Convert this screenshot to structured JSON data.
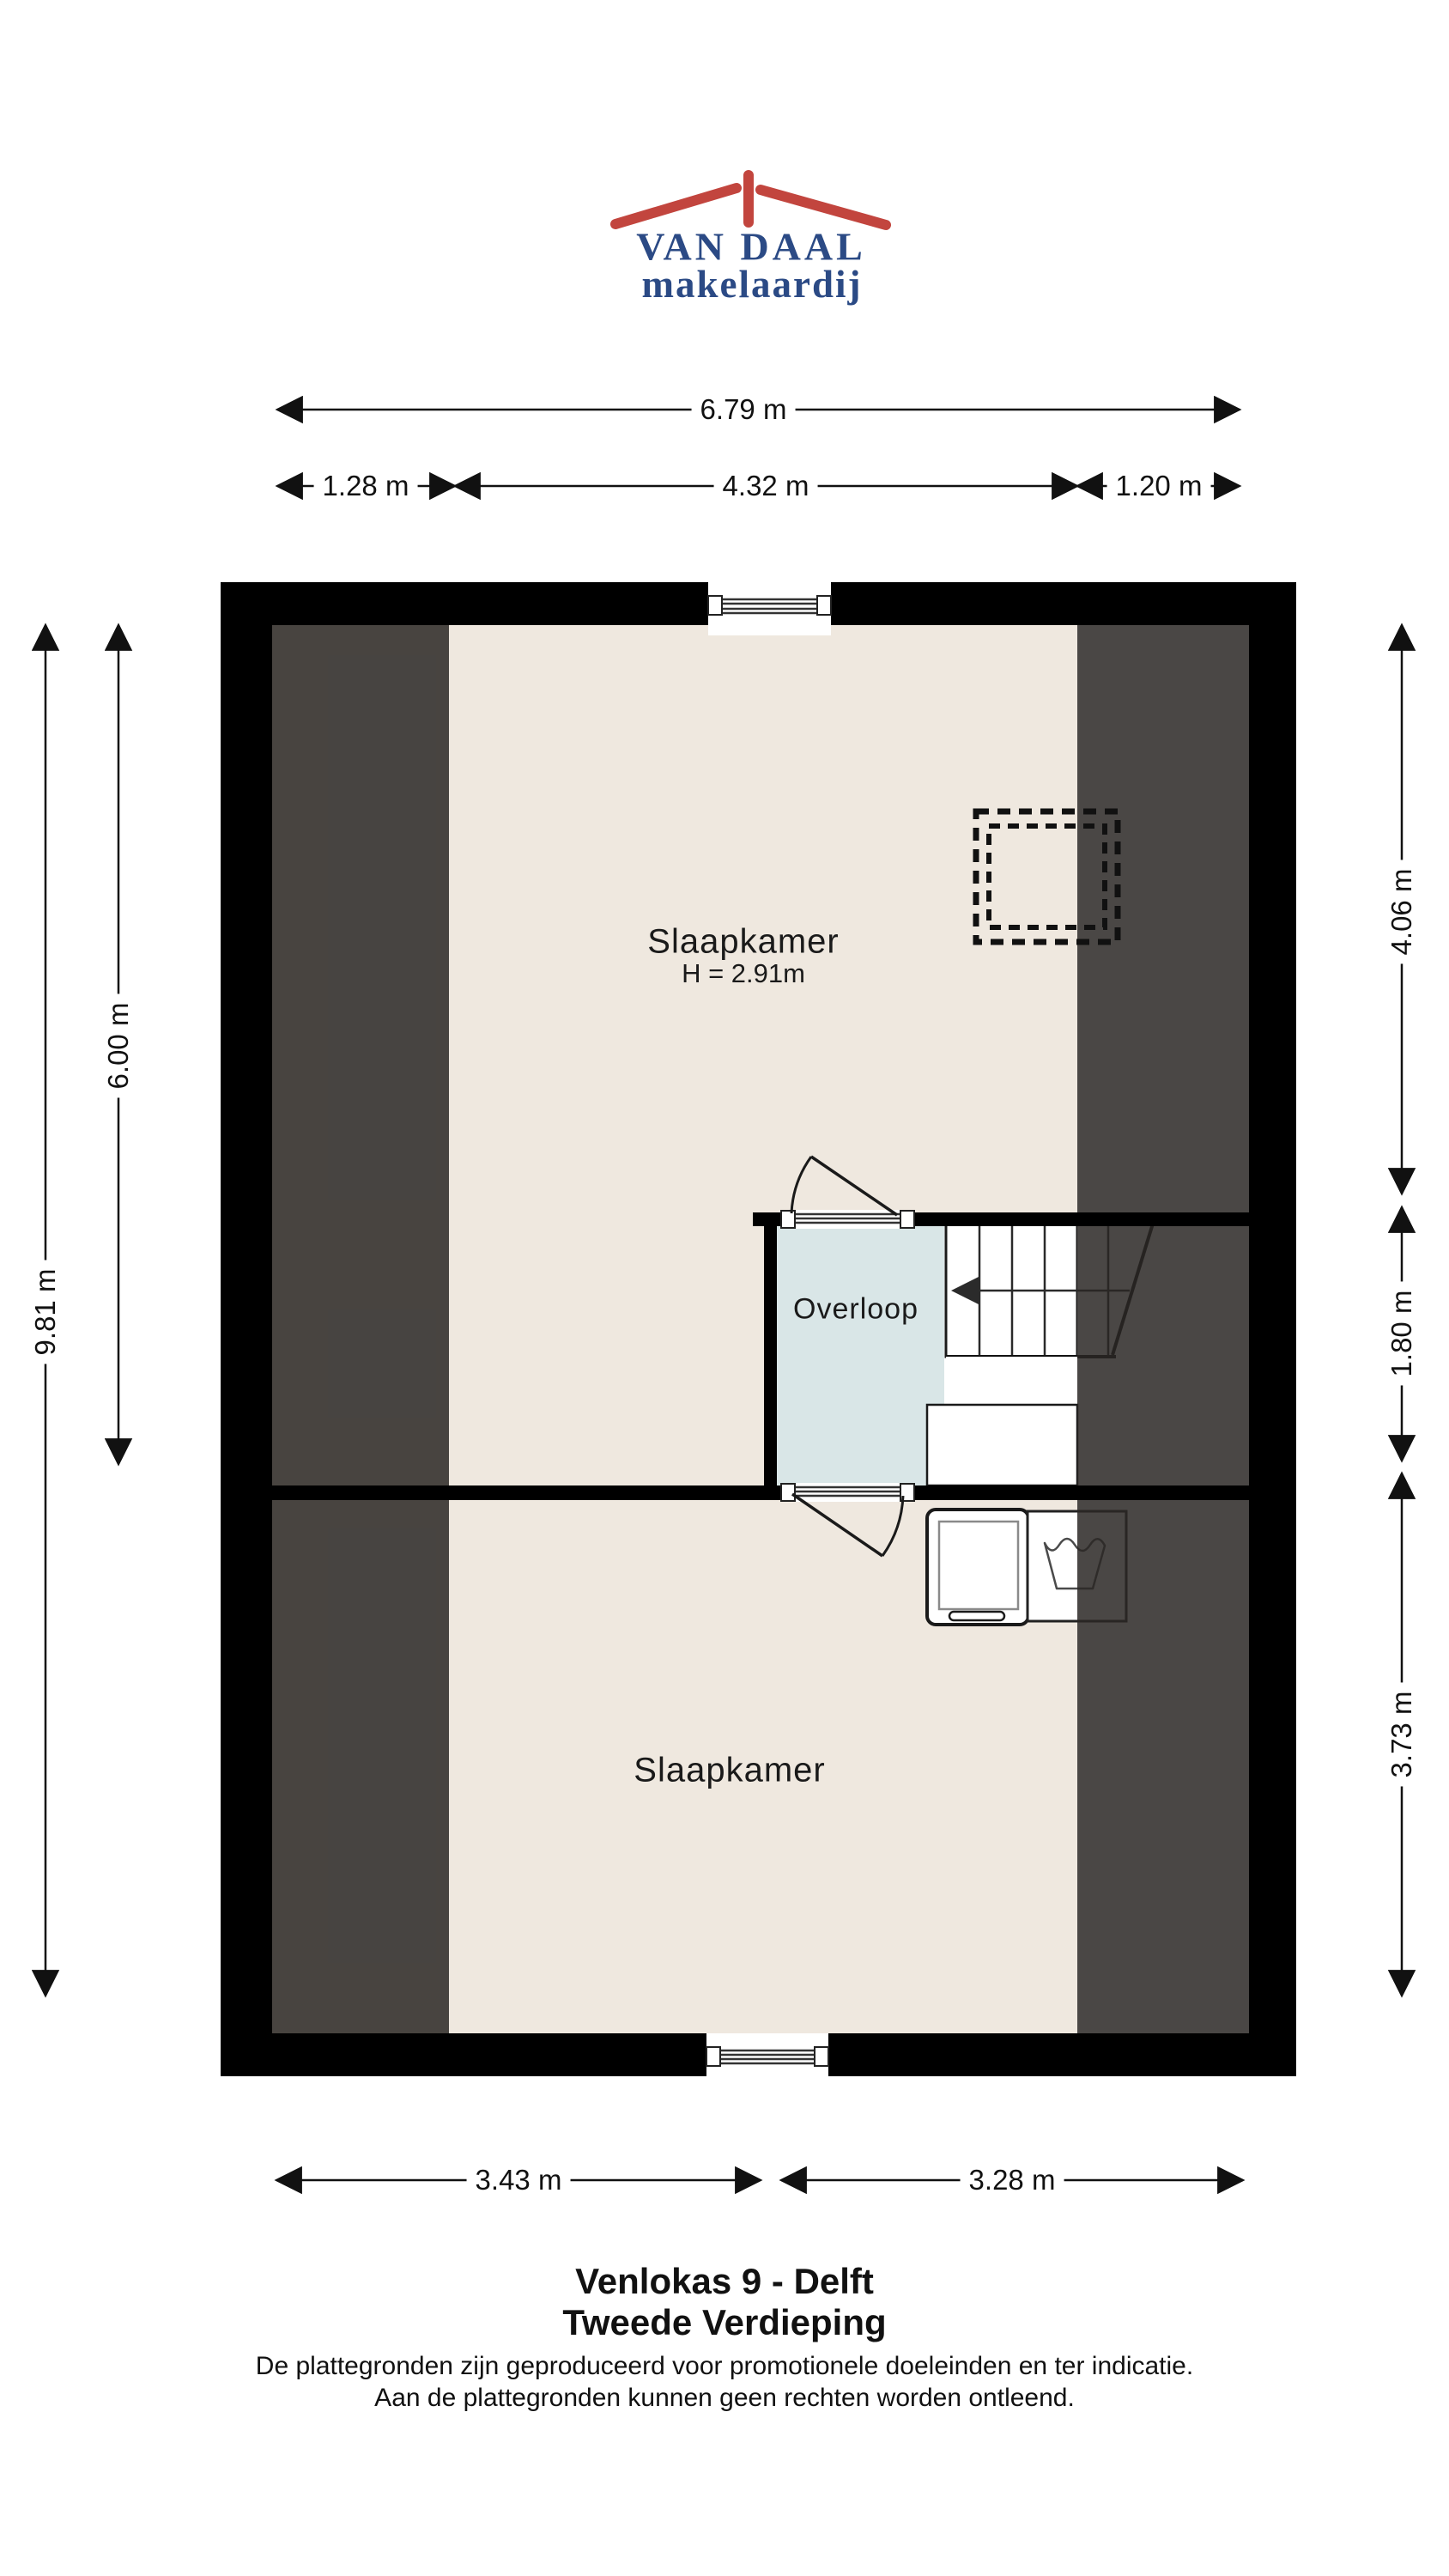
{
  "brand": {
    "name": "VAN DAAL",
    "tagline": "makelaardij",
    "roof_color": "#C2453E",
    "text_color": "#2B4A85"
  },
  "palette": {
    "floor_beige": "#EFE8DF",
    "landing_blue": "#D9E6E7",
    "roof_zone_dark": "#4B4845",
    "wall_black": "#000000",
    "stair_white": "#FFFFFF"
  },
  "rooms": {
    "bedroom_top": {
      "label": "Slaapkamer",
      "ceiling_height": "H = 2.91m"
    },
    "landing": {
      "label": "Overloop"
    },
    "bedroom_bottom": {
      "label": "Slaapkamer"
    }
  },
  "dimensions": {
    "top_total": "6.79 m",
    "top_left": "1.28 m",
    "top_middle": "4.32 m",
    "top_right": "1.20 m",
    "left_total": "9.81 m",
    "left_upper": "6.00 m",
    "right_upper": "4.06 m",
    "right_middle": "1.80 m",
    "right_lower": "3.73 m",
    "bottom_left": "3.43 m",
    "bottom_right": "3.28 m"
  },
  "footer": {
    "title": "Venlokas 9 - Delft",
    "subtitle": "Tweede Verdieping",
    "disclaimer_line1": "De plattegronden zijn geproduceerd voor promotionele doeleinden en ter indicatie.",
    "disclaimer_line2": "Aan de plattegronden kunnen geen rechten worden ontleend."
  }
}
